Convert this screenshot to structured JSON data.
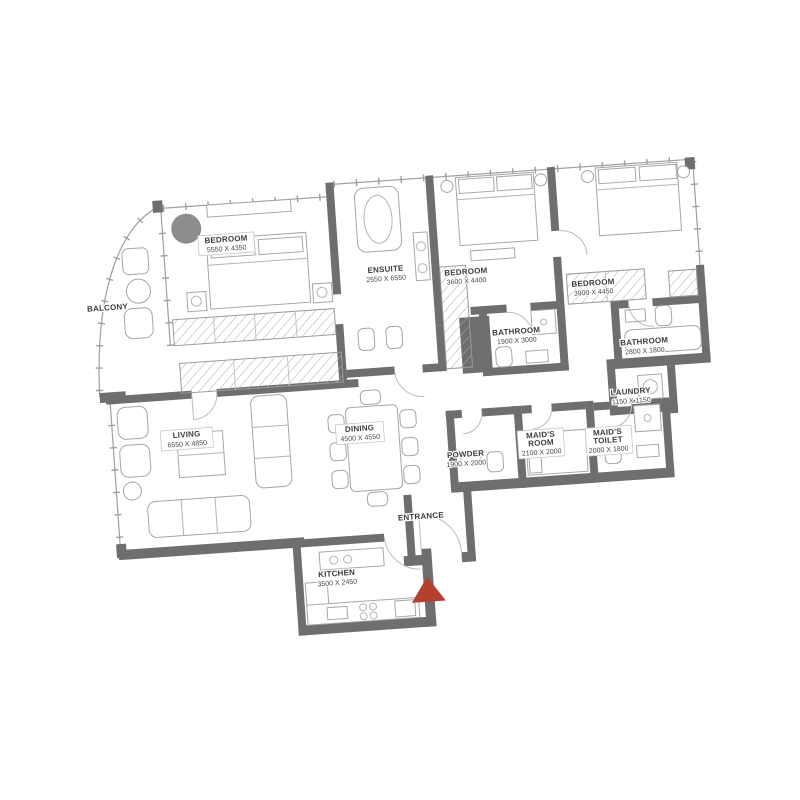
{
  "plan": {
    "title": "apartment-floor-plan",
    "colors": {
      "wall": "#6e6e6e",
      "furniture_line": "#a6a6a6",
      "text": "#3d3d3d",
      "entrance_marker": "#b6402f",
      "rug": "#8d8d8d",
      "background": "#ffffff"
    },
    "rooms": {
      "balcony": {
        "name": "BALCONY",
        "dims": ""
      },
      "bedroom1": {
        "name": "BEDROOM",
        "dims": "5550 X 4350"
      },
      "ensuite": {
        "name": "ENSUITE",
        "dims": "2550 X 6550"
      },
      "bedroom2": {
        "name": "BEDROOM",
        "dims": "3600 X 4400"
      },
      "bathroom1": {
        "name": "BATHROOM",
        "dims": "1900 X 3000"
      },
      "bedroom3": {
        "name": "BEDROOM",
        "dims": "3900 X 4450"
      },
      "bathroom2": {
        "name": "BATHROOM",
        "dims": "2800 X 1800"
      },
      "laundry": {
        "name": "LAUNDRY",
        "dims": "1150 X 1150"
      },
      "maids_room": {
        "line1": "MAID'S",
        "line2": "ROOM",
        "dims": "2100 X 2000"
      },
      "maids_toilet": {
        "line1": "MAID'S",
        "line2": "TOILET",
        "dims": "2000 X 1800"
      },
      "powder": {
        "name": "POWDER",
        "dims": "1900 X 2000"
      },
      "living": {
        "name": "LIVING",
        "dims": "6550 X 4850"
      },
      "dining": {
        "name": "DINING",
        "dims": "4500 X 4550"
      },
      "kitchen": {
        "name": "KITCHEN",
        "dims": "3500 X 2450"
      },
      "entrance": {
        "name": "ENTRANCE",
        "dims": ""
      }
    }
  }
}
